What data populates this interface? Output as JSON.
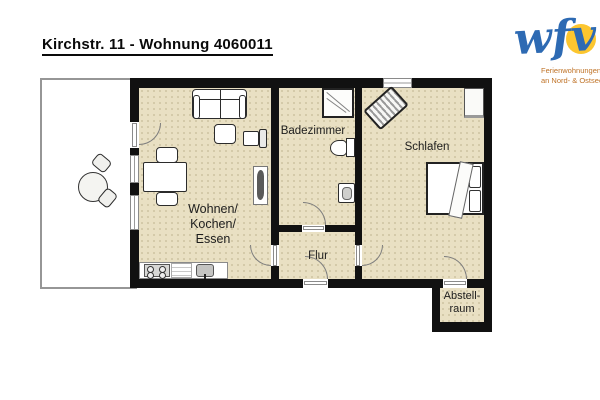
{
  "title": "Kirchstr. 11 - Wohnung 4060011",
  "logo": {
    "wordmark": "wfv",
    "tagline": [
      "Ferienwohnungen",
      "an Nord- & Ostsee"
    ],
    "colors": {
      "wordmark_blue": "#2d6ab3",
      "sun_yellow": "#fcc62f",
      "tagline_orange": "#bf7226"
    }
  },
  "rooms": {
    "living": {
      "lines": [
        "Wohnen/",
        "Kochen/",
        "Essen"
      ]
    },
    "bathroom": {
      "label": "Badezimmer"
    },
    "bedroom": {
      "label": "Schlafen"
    },
    "hallway": {
      "label": "Flur"
    },
    "storage": {
      "lines": [
        "Abstell-",
        "raum"
      ]
    }
  },
  "colors": {
    "floor": "#e9e0c3",
    "wall": "#111111",
    "terrace_border": "#969696"
  },
  "furniture": [
    "sofa",
    "coffee-table",
    "armchair",
    "dining-table",
    "dining-chairs",
    "kitchen-counter",
    "stove",
    "kitchen-sink",
    "radiator",
    "shower",
    "toilet",
    "washbasin",
    "wardrobe",
    "striped-cabinet",
    "double-bed",
    "pillows",
    "blanket",
    "terrace-table",
    "terrace-chairs"
  ]
}
